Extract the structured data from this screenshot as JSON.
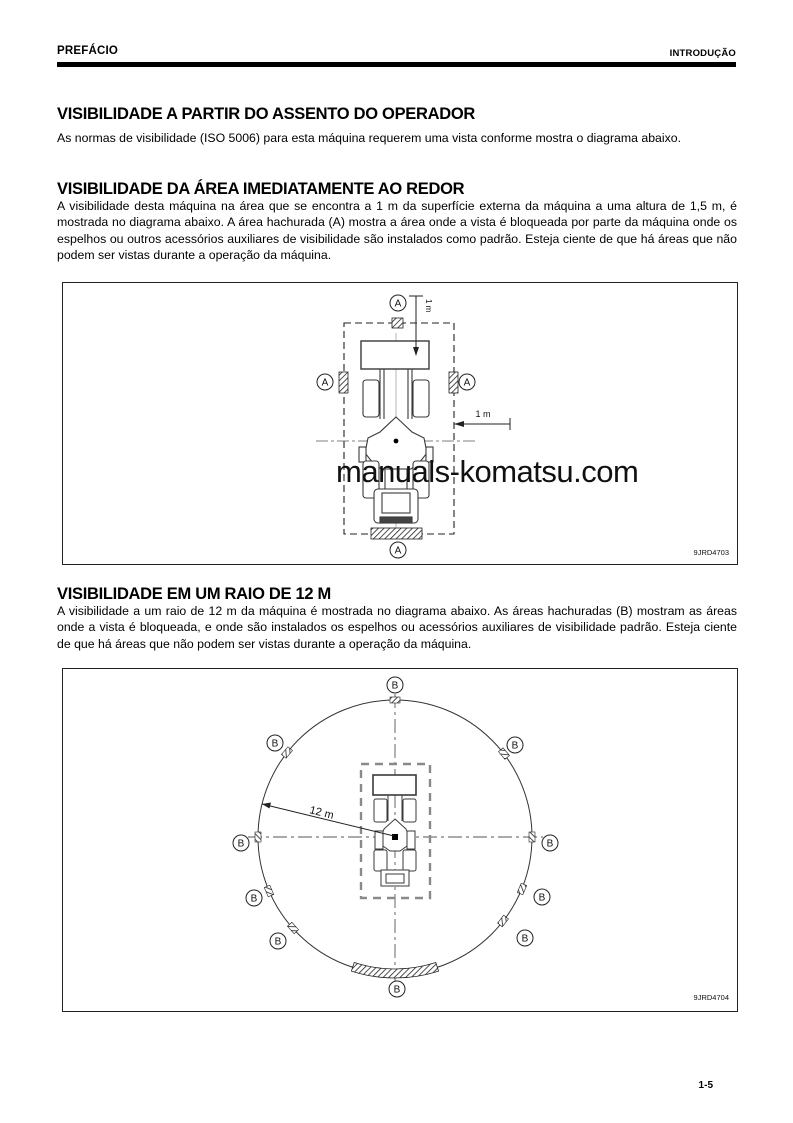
{
  "header": {
    "left": "PREFÁCIO",
    "right": "INTRODUÇÃO"
  },
  "sections": [
    {
      "heading": "VISIBILIDADE A PARTIR DO ASSENTO DO OPERADOR",
      "body": "As normas de visibilidade (ISO 5006) para esta máquina requerem uma vista conforme mostra o diagrama abaixo."
    },
    {
      "heading": "VISIBILIDADE DA ÁREA IMEDIATAMENTE AO REDOR",
      "body": "A visibilidade desta máquina na área que se encontra a 1 m da superfície externa da máquina a uma altura de 1,5 m, é mostrada no diagrama abaixo. A área hachurada (A) mostra a área onde a vista é bloqueada por parte da máquina onde os espelhos ou outros acessórios auxiliares de visibilidade são instalados como padrão. Esteja ciente de que há áreas que não podem ser vistas durante a operação da máquina."
    },
    {
      "heading": "VISIBILIDADE EM UM RAIO DE 12 M",
      "body": "A visibilidade a um raio de 12 m da máquina é mostrada no diagrama abaixo. As áreas hachuradas (B) mostram as áreas onde a vista é bloqueada, e onde são instalados os espelhos ou acessórios auxiliares de visibilidade padrão. Esteja ciente de que há áreas que não podem ser vistas durante a operação da máquina."
    }
  ],
  "figures": {
    "fig1": {
      "marker": "A",
      "dim_top": "1 m",
      "dim_right": "1 m",
      "code": "9JRD4703",
      "watermark": "manuals-komatsu.com"
    },
    "fig2": {
      "marker": "B",
      "radius": "12 m",
      "code": "9JRD4704"
    }
  },
  "footer": {
    "page": "1-5"
  },
  "colors": {
    "ink": "#000000",
    "diagram_line": "#333333",
    "watermark": "#1c1c1c"
  }
}
